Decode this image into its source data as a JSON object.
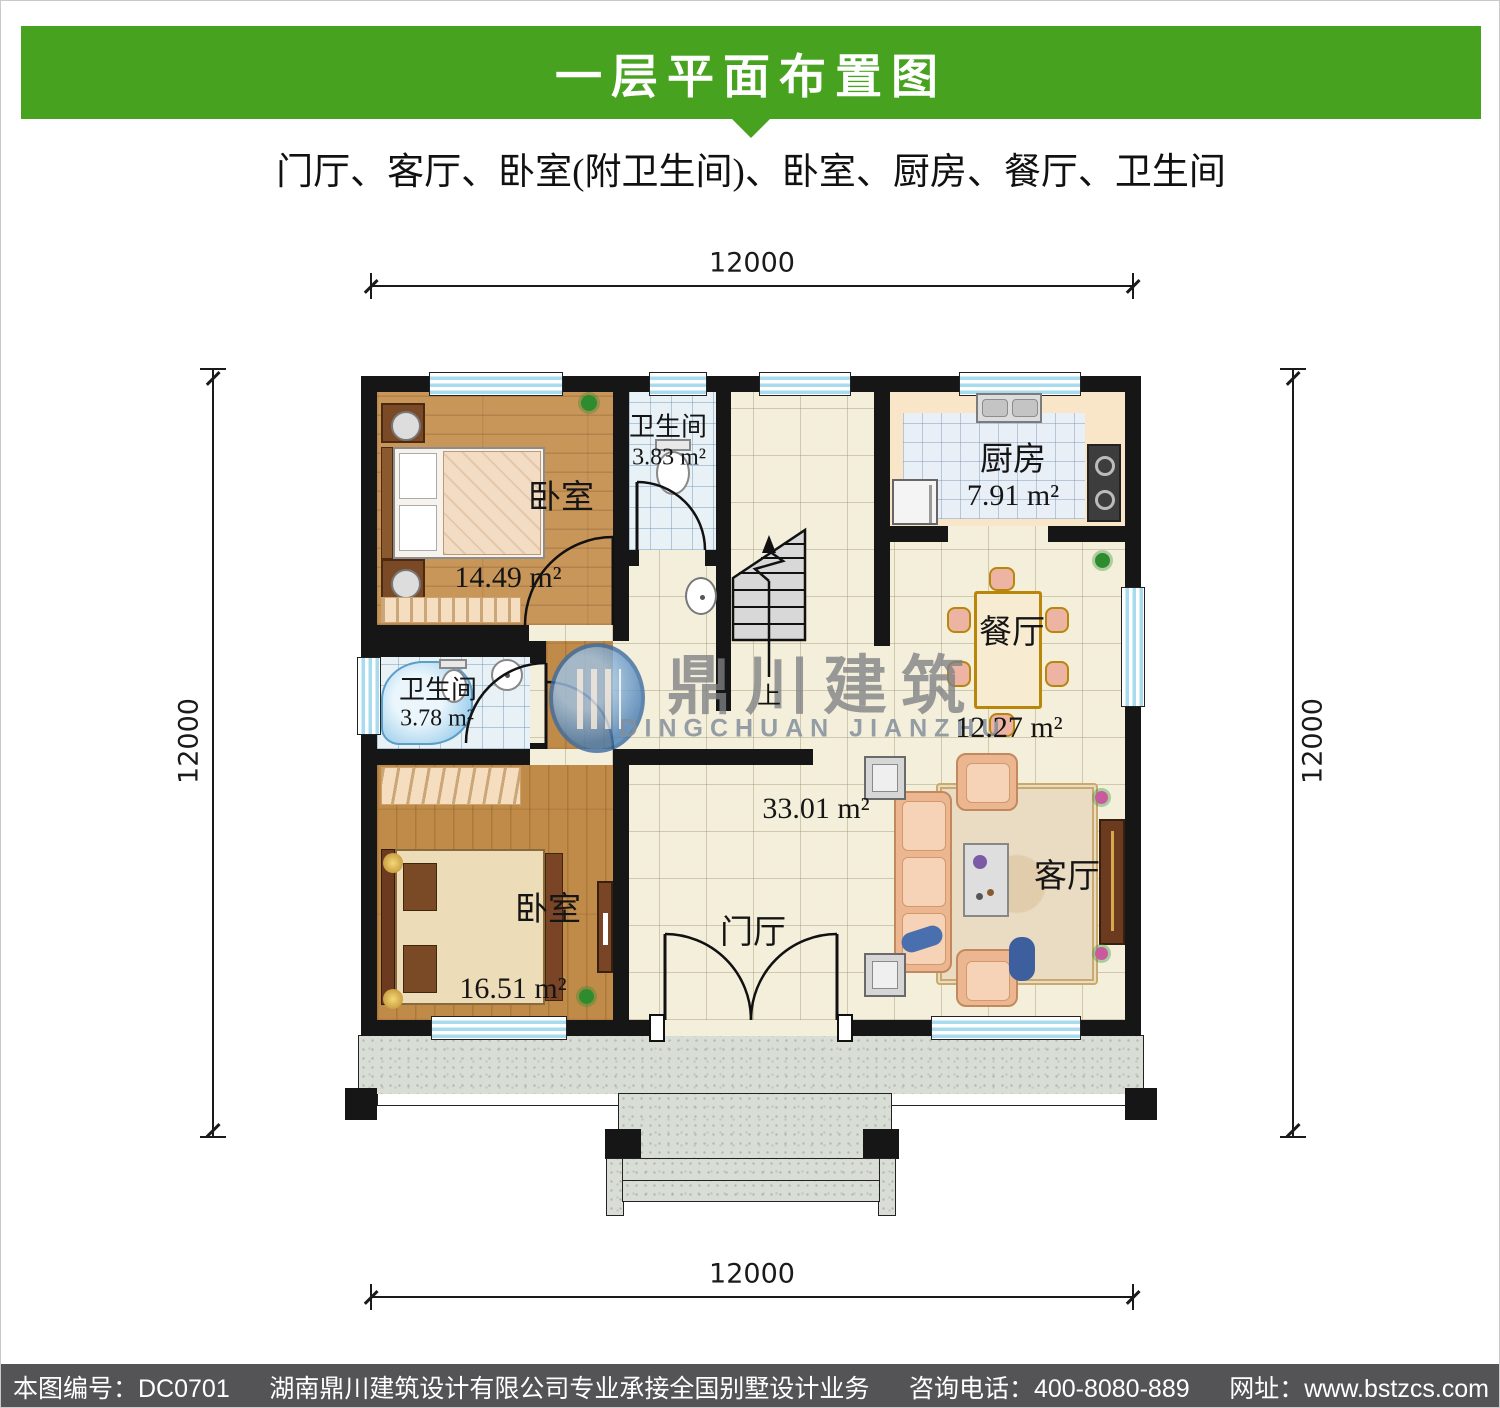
{
  "header": {
    "title": "一层平面布置图",
    "subtitle": "门厅、客厅、卧室(附卫生间)、卧室、厨房、餐厅、卫生间"
  },
  "dimensions": {
    "top": "12000",
    "bottom": "12000",
    "left": "12000",
    "right": "12000"
  },
  "rooms": {
    "bedroom_top": {
      "name": "卧室",
      "area": "14.49 m²"
    },
    "bath_top": {
      "name": "卫生间",
      "area": "3.83 m²"
    },
    "kitchen": {
      "name": "厨房",
      "area": "7.91 m²"
    },
    "dining": {
      "name": "餐厅",
      "area": "12.27 m²"
    },
    "bath_left": {
      "name": "卫生间",
      "area": "3.78 m²"
    },
    "bedroom_bottom": {
      "name": "卧室",
      "area": "16.51 m²"
    },
    "entry_hall": {
      "name": "门厅",
      "area": "33.01 m²"
    },
    "living": {
      "name": "客厅"
    }
  },
  "stairs": {
    "up": "上"
  },
  "watermark": {
    "cn": "鼎川建筑",
    "en": "DINGCHUAN JIANZHU"
  },
  "footer": {
    "parts": [
      "本图编号：DC0701",
      "湖南鼎川建筑设计有限公司专业承接全国别墅设计业务",
      "咨询电话：400-8080-889",
      "网址：www.bstzcs.com"
    ]
  },
  "colors": {
    "header_green": "#47a31f",
    "footer_gray": "#545457",
    "wall": "#161616",
    "window_blue": "#a9dbee",
    "wood": "#c9965a",
    "tile": "#f4efdb",
    "bath_tile": "#e8f1f6",
    "kitchen": "#f9e6c8",
    "granite": "#d8ddd6",
    "watermark_blue": "#4a7fb5"
  }
}
